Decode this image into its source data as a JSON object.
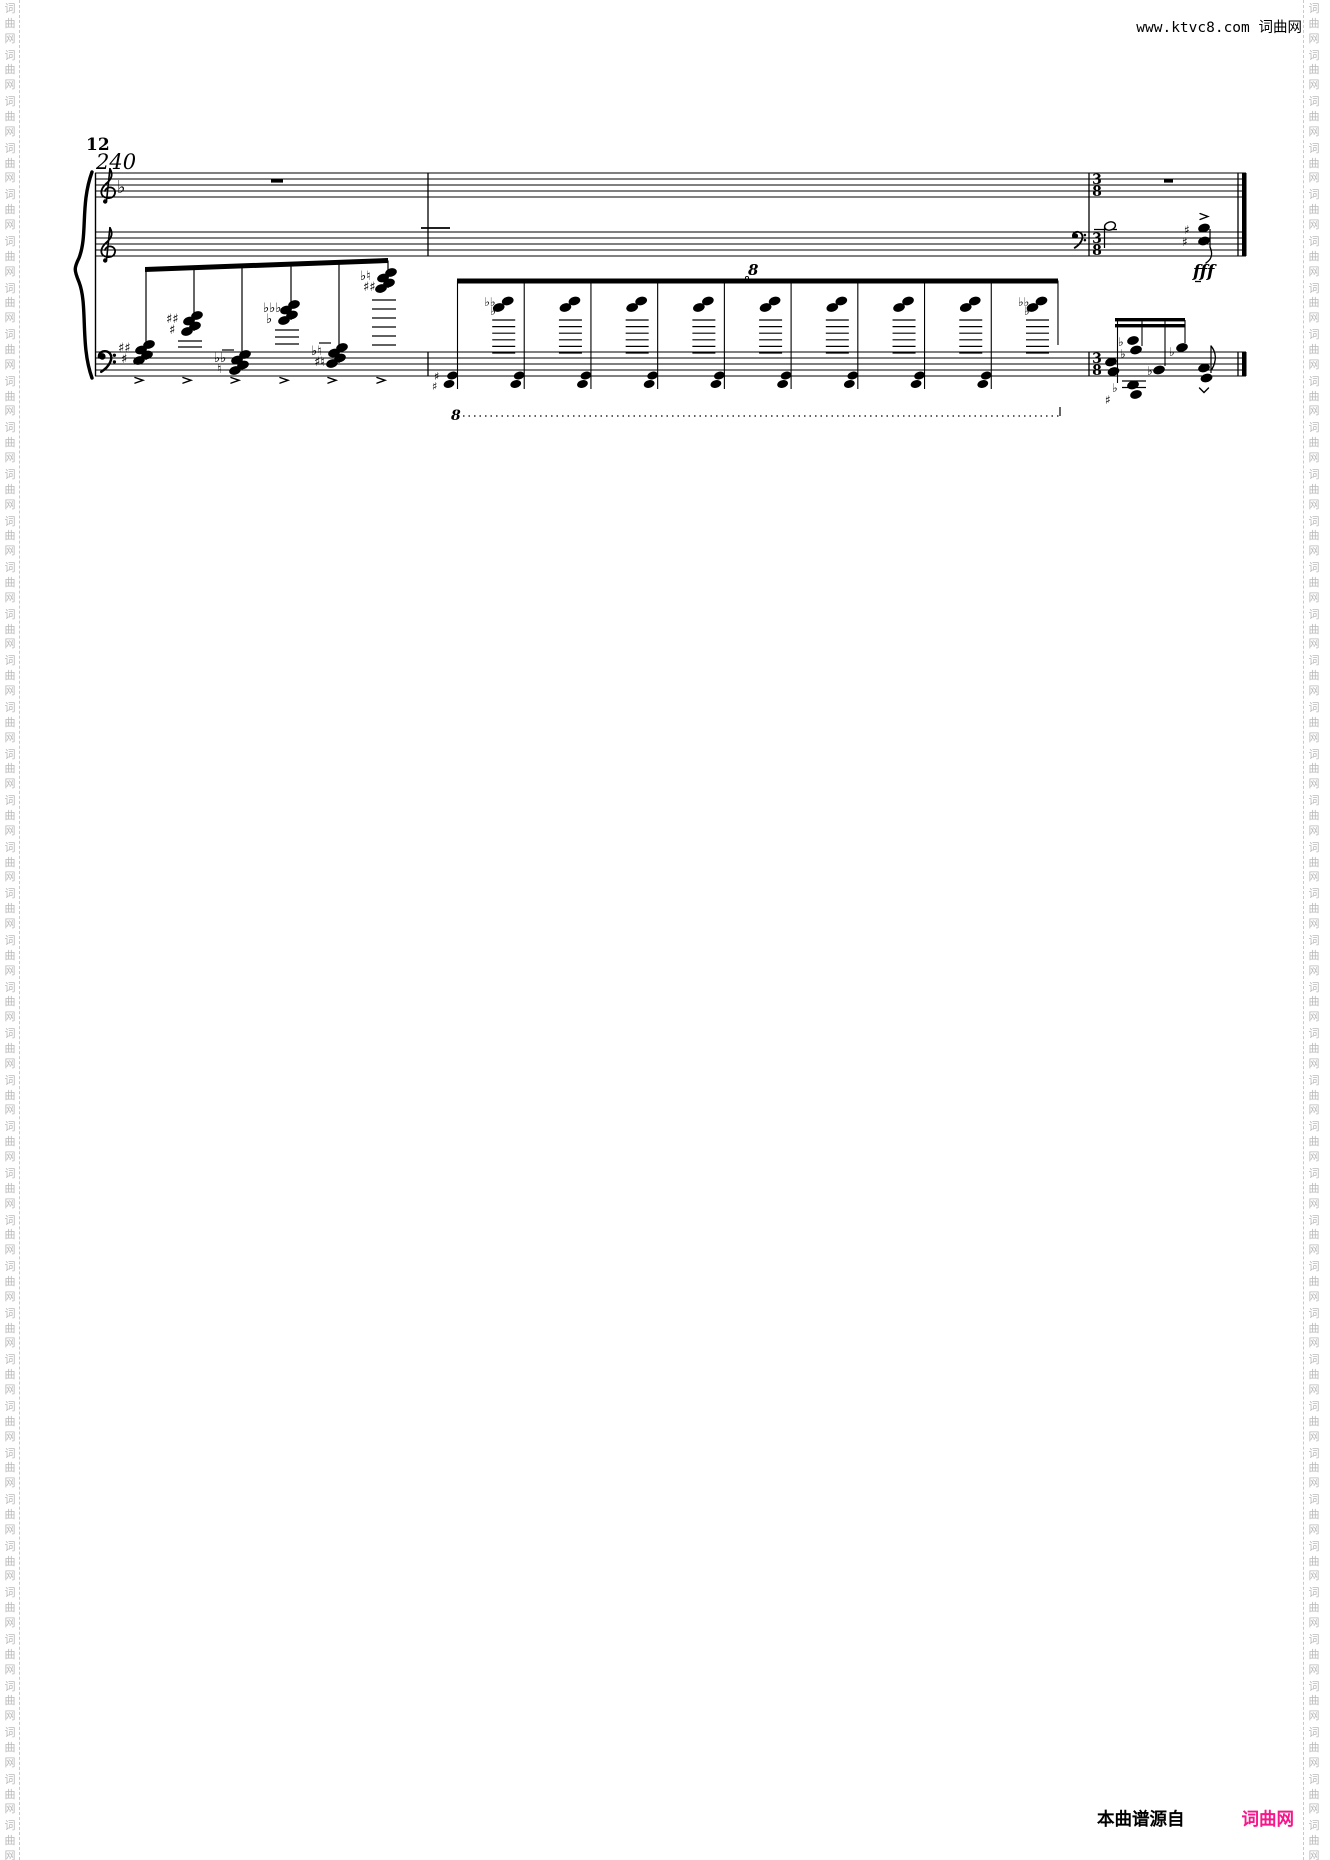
{
  "header": {
    "site_text": "www.ktvc8.com 词曲网"
  },
  "footer": {
    "attribution": "本曲谱源自",
    "site_name": "词曲网",
    "site_color": "#f8168b"
  },
  "watermark": {
    "chars": [
      "词",
      "曲",
      "网"
    ],
    "color": "#b9b9b9"
  },
  "score": {
    "rehearsal_number": "12",
    "tempo": "240",
    "dynamics": "fff",
    "time_signature": {
      "num": "3",
      "den": "8"
    },
    "ottava_alta": "8",
    "ottava_bassa": "8",
    "staves": [
      {
        "y": 173,
        "clef": "treble",
        "flats": 1
      },
      {
        "y": 232,
        "clef": "treble",
        "flats": 0
      },
      {
        "y": 352,
        "clef": "bass",
        "flats": 0
      }
    ],
    "layout": {
      "left": 95,
      "right": 1246,
      "gap": 6
    },
    "barlines": [
      428,
      1089
    ],
    "final_barline": 1238,
    "whole_rests": [
      {
        "x": 271,
        "w": 12
      },
      {
        "x": 1164,
        "w": 9
      }
    ],
    "clef_change": {
      "x": 1073,
      "staff": 1
    },
    "time_sig_x": 1097,
    "stray_ledger": {
      "x1": 421,
      "x2": 450,
      "y": 228
    },
    "ascending_run": {
      "beam": {
        "x1": 145,
        "y1": 269.5,
        "x2": 388,
        "y2": 260.5,
        "t": 5
      },
      "chords": [
        {
          "x": 146,
          "y": 344,
          "acc": [
            "♯♯",
            "♯"
          ],
          "ledgers": [],
          "dash": false
        },
        {
          "x": 194,
          "y": 315,
          "acc": [
            "♯♯",
            "♯"
          ],
          "ledgers": [
            341,
            347
          ],
          "dash": false
        },
        {
          "x": 242,
          "y": 354,
          "acc": [
            "♭♭",
            "♮"
          ],
          "ledgers": [],
          "dash": true
        },
        {
          "x": 291,
          "y": 304,
          "acc": [
            "♭♭♭",
            "♭"
          ],
          "ledgers": [
            330,
            337,
            344
          ],
          "dash": false
        },
        {
          "x": 339,
          "y": 347,
          "acc": [
            "♭♮",
            "♯♮"
          ],
          "ledgers": [],
          "dash": true
        },
        {
          "x": 388,
          "y": 272,
          "acc": [
            "♭♮",
            "♯♯"
          ],
          "ledgers": [
            300,
            309,
            318,
            327,
            336,
            345
          ],
          "dash": false
        }
      ]
    },
    "tremolo_run": {
      "beam": {
        "x1": 457,
        "x2": 1058,
        "y": 278.5,
        "t": 5
      },
      "stem_count": 10,
      "stem_step": 66.72,
      "chord_y": 304,
      "low_y": 380,
      "first_upper_acc": [
        "♭♭",
        "♭"
      ],
      "last_upper_acc": [
        "♭♭",
        "♭"
      ],
      "first_low_acc": [
        "♯",
        "♯"
      ],
      "ottava": {
        "x": 748,
        "y": 275
      }
    },
    "ottava_line": {
      "label_x": 451,
      "label_y": 420,
      "x1": 463,
      "x2": 1060,
      "y": 416
    },
    "upper_final": {
      "half_note": {
        "x": 1110,
        "y": 226
      },
      "chord": {
        "x": 1204,
        "y1": 228,
        "y2": 241,
        "acc": [
          "♯",
          "♯"
        ]
      },
      "fff_pos": {
        "x": 1193,
        "y": 277
      }
    },
    "lower_final": {
      "beams_y": [
        318,
        324
      ],
      "beam_x": [
        1115,
        1185
      ],
      "low_cluster": {
        "x": 1133,
        "y": 385,
        "acc": [
          "♭",
          "♯"
        ]
      },
      "events": [
        {
          "stem": 1117.5,
          "heads": [
            [
              1111,
              362
            ],
            [
              1113.5,
              371.5
            ]
          ],
          "acc": [],
          "stem_to": 383
        },
        {
          "stem": 1142,
          "heads": [
            [
              1133,
              340.5
            ],
            [
              1136,
              350
            ]
          ],
          "acc": [
            [
              "♭",
              1118,
              346
            ],
            [
              "♭",
              1120,
              358
            ]
          ],
          "stem_to": 346
        },
        {
          "stem": 1165,
          "heads": [
            [
              1159,
              370
            ]
          ],
          "acc": [
            [
              "♭",
              1147,
              375
            ]
          ],
          "stem_to": 366
        },
        {
          "stem": 1185,
          "heads": [
            [
              1182,
              347.5
            ]
          ],
          "acc": [
            [
              "♭",
              1169,
              356
            ]
          ],
          "stem_to": 343
        }
      ],
      "final_eighth": {
        "heads": [
          [
            1204,
            368
          ],
          [
            1206.5,
            378
          ]
        ]
      }
    }
  }
}
